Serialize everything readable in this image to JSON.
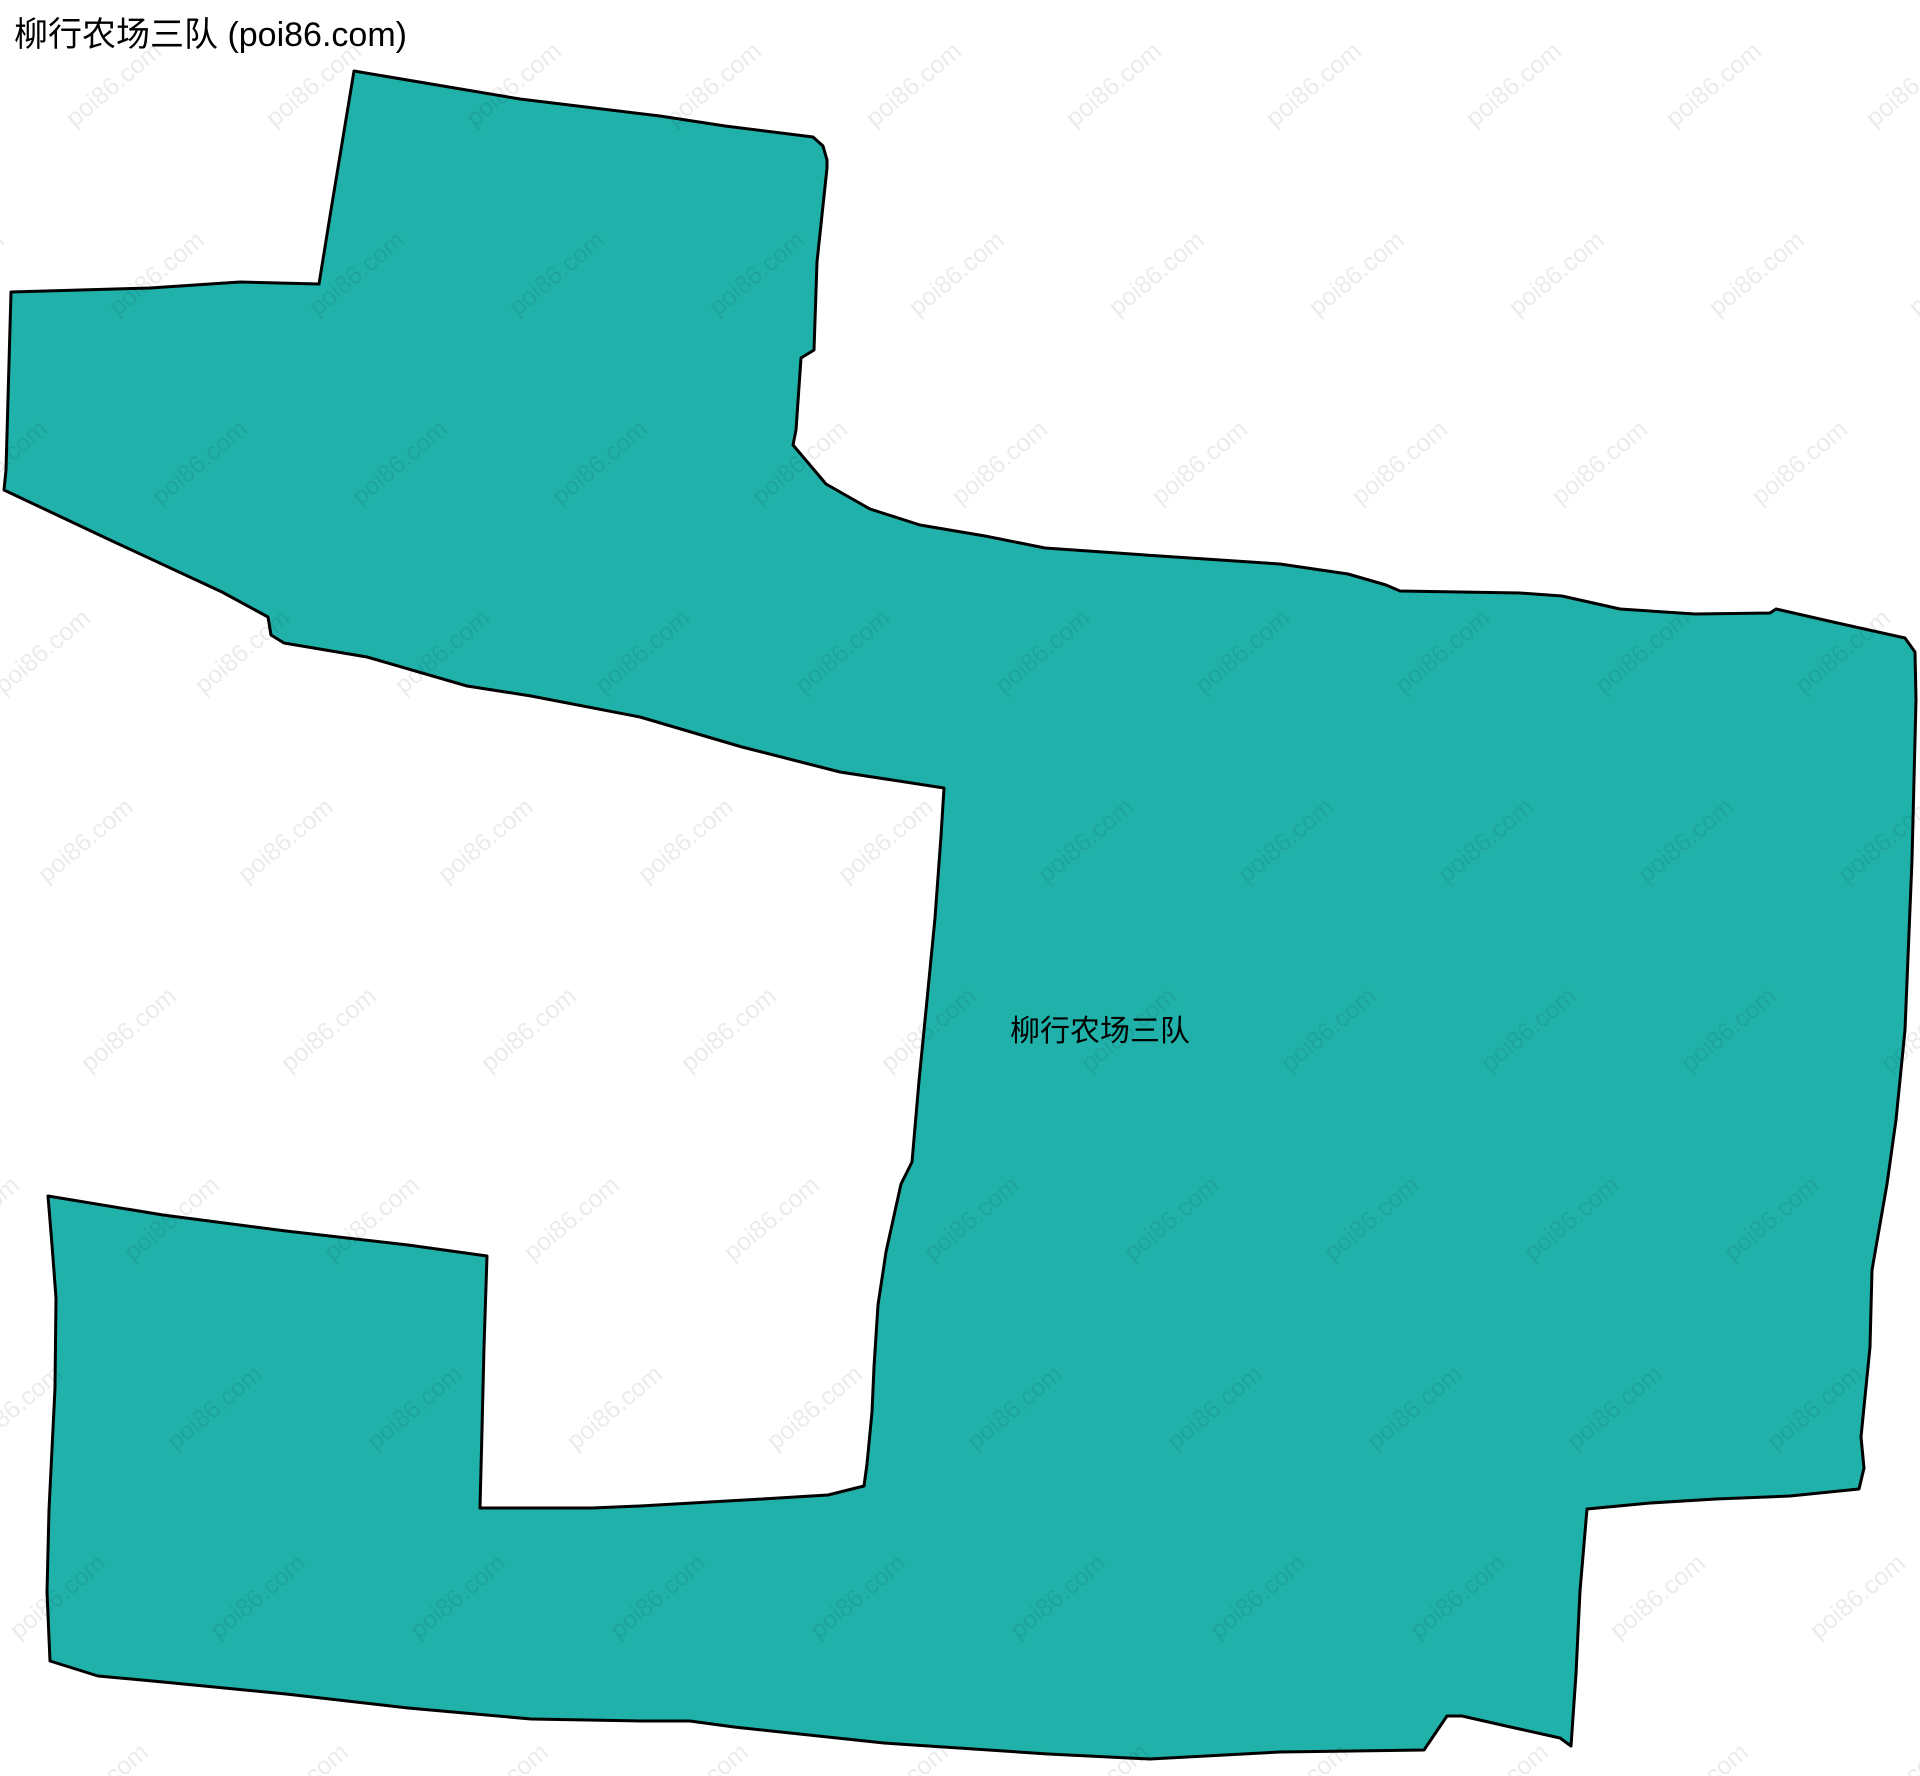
{
  "page": {
    "width": 1920,
    "height": 1776,
    "background_color": "#ffffff"
  },
  "header": {
    "title": "柳行农场三队 (poi86.com)",
    "color": "#000000",
    "font_size_px": 34
  },
  "map": {
    "region_label": "柳行农场三队",
    "label_color": "#000000",
    "label_font_size_px": 30,
    "label_position": {
      "x": 1100,
      "y": 1028
    },
    "fill_color": "#20b2aa",
    "stroke_color": "#000000",
    "stroke_width": 3,
    "boundary_points": [
      [
        354,
        71
      ],
      [
        520,
        99
      ],
      [
        660,
        116
      ],
      [
        725,
        126
      ],
      [
        813,
        137
      ],
      [
        823,
        146
      ],
      [
        827,
        160
      ],
      [
        827,
        168
      ],
      [
        817,
        262
      ],
      [
        814,
        350
      ],
      [
        801,
        358
      ],
      [
        796,
        430
      ],
      [
        793,
        445
      ],
      [
        826,
        484
      ],
      [
        870,
        509
      ],
      [
        920,
        525
      ],
      [
        985,
        536
      ],
      [
        1045,
        548
      ],
      [
        1160,
        556
      ],
      [
        1280,
        564
      ],
      [
        1348,
        574
      ],
      [
        1386,
        585
      ],
      [
        1400,
        591
      ],
      [
        1520,
        593
      ],
      [
        1562,
        596
      ],
      [
        1620,
        609
      ],
      [
        1695,
        614
      ],
      [
        1770,
        613
      ],
      [
        1776,
        609
      ],
      [
        1833,
        622
      ],
      [
        1905,
        638
      ],
      [
        1915,
        652
      ],
      [
        1916,
        700
      ],
      [
        1912,
        860
      ],
      [
        1905,
        1030
      ],
      [
        1896,
        1120
      ],
      [
        1887,
        1184
      ],
      [
        1872,
        1270
      ],
      [
        1870,
        1347
      ],
      [
        1861,
        1437
      ],
      [
        1864,
        1468
      ],
      [
        1859,
        1489
      ],
      [
        1790,
        1496
      ],
      [
        1716,
        1499
      ],
      [
        1650,
        1503
      ],
      [
        1587,
        1509
      ],
      [
        1580,
        1591
      ],
      [
        1576,
        1674
      ],
      [
        1571,
        1746
      ],
      [
        1560,
        1738
      ],
      [
        1506,
        1726
      ],
      [
        1462,
        1716
      ],
      [
        1447,
        1716
      ],
      [
        1424,
        1750
      ],
      [
        1280,
        1752
      ],
      [
        1150,
        1759
      ],
      [
        1048,
        1754
      ],
      [
        884,
        1743
      ],
      [
        734,
        1727
      ],
      [
        690,
        1721
      ],
      [
        640,
        1721
      ],
      [
        531,
        1719
      ],
      [
        408,
        1708
      ],
      [
        286,
        1694
      ],
      [
        163,
        1682
      ],
      [
        98,
        1676
      ],
      [
        50,
        1661
      ],
      [
        47,
        1592
      ],
      [
        49,
        1510
      ],
      [
        55,
        1388
      ],
      [
        56,
        1298
      ],
      [
        52,
        1245
      ],
      [
        48,
        1196
      ],
      [
        163,
        1215
      ],
      [
        286,
        1231
      ],
      [
        408,
        1245
      ],
      [
        487,
        1256
      ],
      [
        484,
        1347
      ],
      [
        482,
        1430
      ],
      [
        480,
        1508
      ],
      [
        592,
        1508
      ],
      [
        640,
        1506
      ],
      [
        762,
        1499
      ],
      [
        828,
        1495
      ],
      [
        864,
        1486
      ],
      [
        867,
        1464
      ],
      [
        872,
        1412
      ],
      [
        874,
        1367
      ],
      [
        878,
        1305
      ],
      [
        886,
        1252
      ],
      [
        901,
        1184
      ],
      [
        912,
        1162
      ],
      [
        919,
        1081
      ],
      [
        927,
        1000
      ],
      [
        935,
        918
      ],
      [
        941,
        836
      ],
      [
        944,
        788
      ],
      [
        840,
        772
      ],
      [
        742,
        747
      ],
      [
        640,
        717
      ],
      [
        531,
        696
      ],
      [
        467,
        686
      ],
      [
        367,
        657
      ],
      [
        284,
        643
      ],
      [
        271,
        635
      ],
      [
        268,
        617
      ],
      [
        222,
        592
      ],
      [
        110,
        540
      ],
      [
        4,
        490
      ],
      [
        6,
        470
      ],
      [
        11,
        292
      ],
      [
        150,
        288
      ],
      [
        240,
        282
      ],
      [
        319,
        284
      ],
      [
        331,
        210
      ]
    ]
  },
  "watermark": {
    "text": "poi86.com",
    "color": "rgba(0,0,0,0.08)",
    "font_size_px": 25,
    "rotation_deg": -40,
    "grid": {
      "x_spacing": 200,
      "y_spacing": 189,
      "row_x_step": 43,
      "x_base": 114,
      "y_base": 85,
      "rows": 10,
      "cols": 12
    }
  }
}
